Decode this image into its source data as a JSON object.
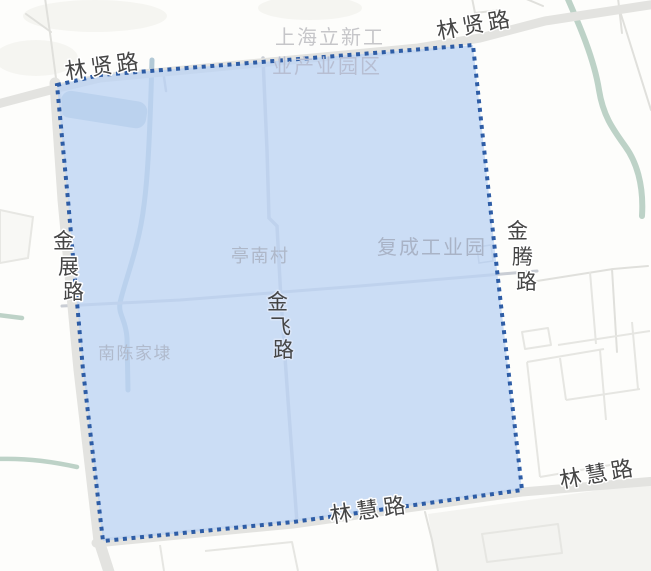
{
  "theme": {
    "map-bg": "#fdfdfb",
    "region-fill": "rgba(189,212,243,0.78)",
    "region-border": "#2e5da6",
    "road-fill": "#e3e3e0",
    "lane-stroke": "#e0e0dc",
    "inner-road-stroke": "#c9cdd4",
    "water-stroke": "#b2c9d6",
    "pond-fill": "#b5cbd9",
    "river-stroke": "#bdd2c7",
    "road-label-color": "#454545",
    "area-label-color": "#c6c6c9",
    "area-label-tinted": "#a9b3c6"
  },
  "map": {
    "labels": {
      "linxian_left": {
        "text": "林贤路"
      },
      "linxian_right": {
        "text": "林贤路"
      },
      "shanghai_lixin": {
        "line1": "上海立新工",
        "line2": "业产业园区"
      },
      "jinzhan": {
        "chars": [
          "金",
          "展",
          "路"
        ]
      },
      "jinteng": {
        "chars": [
          "金",
          "腾",
          "路"
        ]
      },
      "jinfei": {
        "chars": [
          "金",
          "飞",
          "路"
        ]
      },
      "tingnan": {
        "text": "亭南村"
      },
      "fucheng": {
        "text": "复成工业园"
      },
      "nanchen": {
        "text": "南陈家埭"
      },
      "linhui_center": {
        "text": "林慧路"
      },
      "linhui_right": {
        "text": "林慧路"
      }
    }
  }
}
